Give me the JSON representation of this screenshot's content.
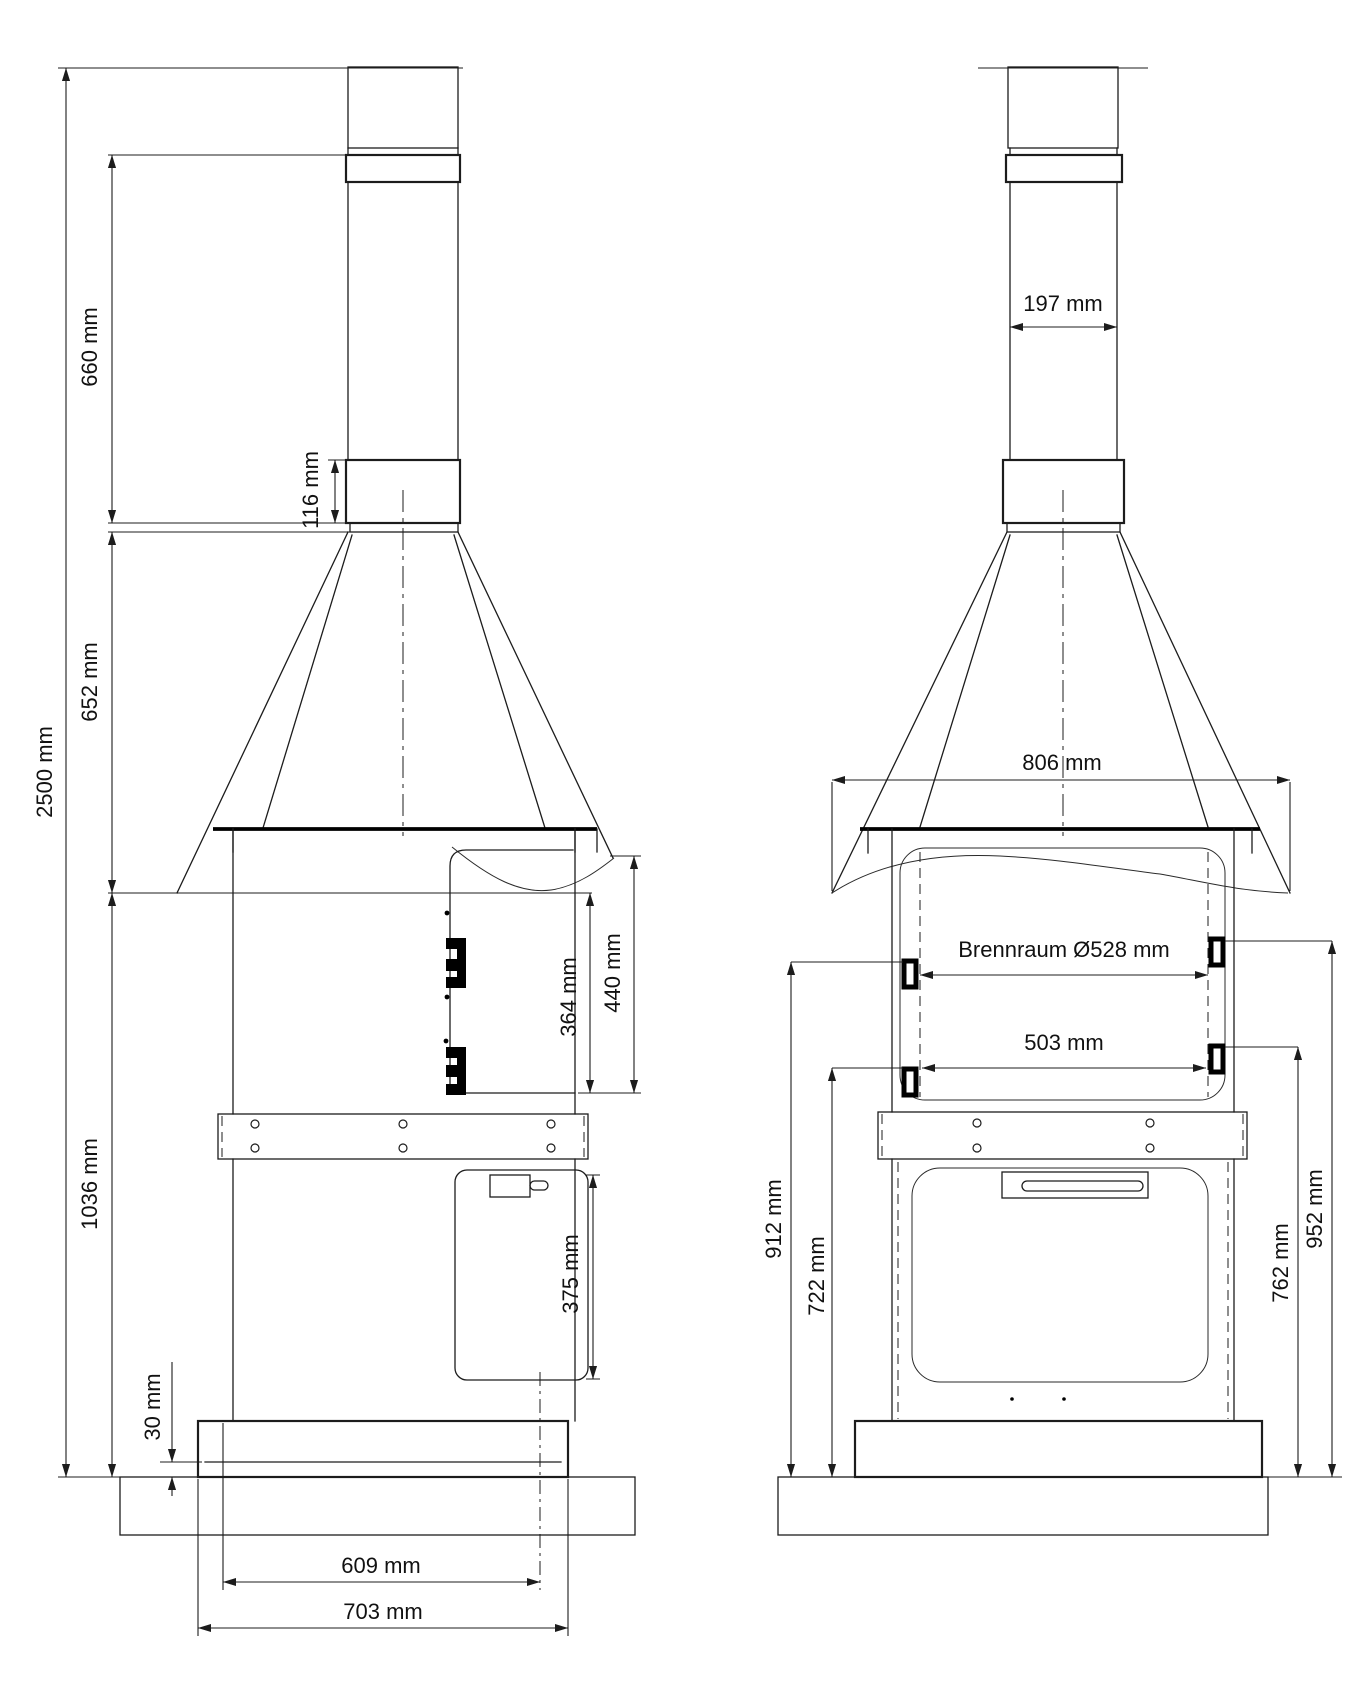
{
  "colors": {
    "background": "#ffffff",
    "line": "#1c1c1c",
    "text": "#111111"
  },
  "side_view": {
    "dims": {
      "overall_height": "2500 mm",
      "chimney_pipe_height": "660 mm",
      "collar_height": "116 mm",
      "hood_height": "652 mm",
      "body_height": "1036 mm",
      "door_opening_height": "364 mm",
      "door_height": "440 mm",
      "tank_height": "375 mm",
      "base_clearance": "30 mm",
      "inner_base_width": "609 mm",
      "base_width": "703 mm"
    }
  },
  "front_view": {
    "dims": {
      "pipe_width": "197 mm",
      "hood_width": "806 mm",
      "combustion_chamber": "Brennraum Ø528 mm",
      "inner_width": "503 mm",
      "upper_left_hinge_height": "912 mm",
      "lower_left_hinge_height": "722 mm",
      "lower_right_hinge_height": "762 mm",
      "upper_right_hinge_height": "952 mm"
    }
  }
}
